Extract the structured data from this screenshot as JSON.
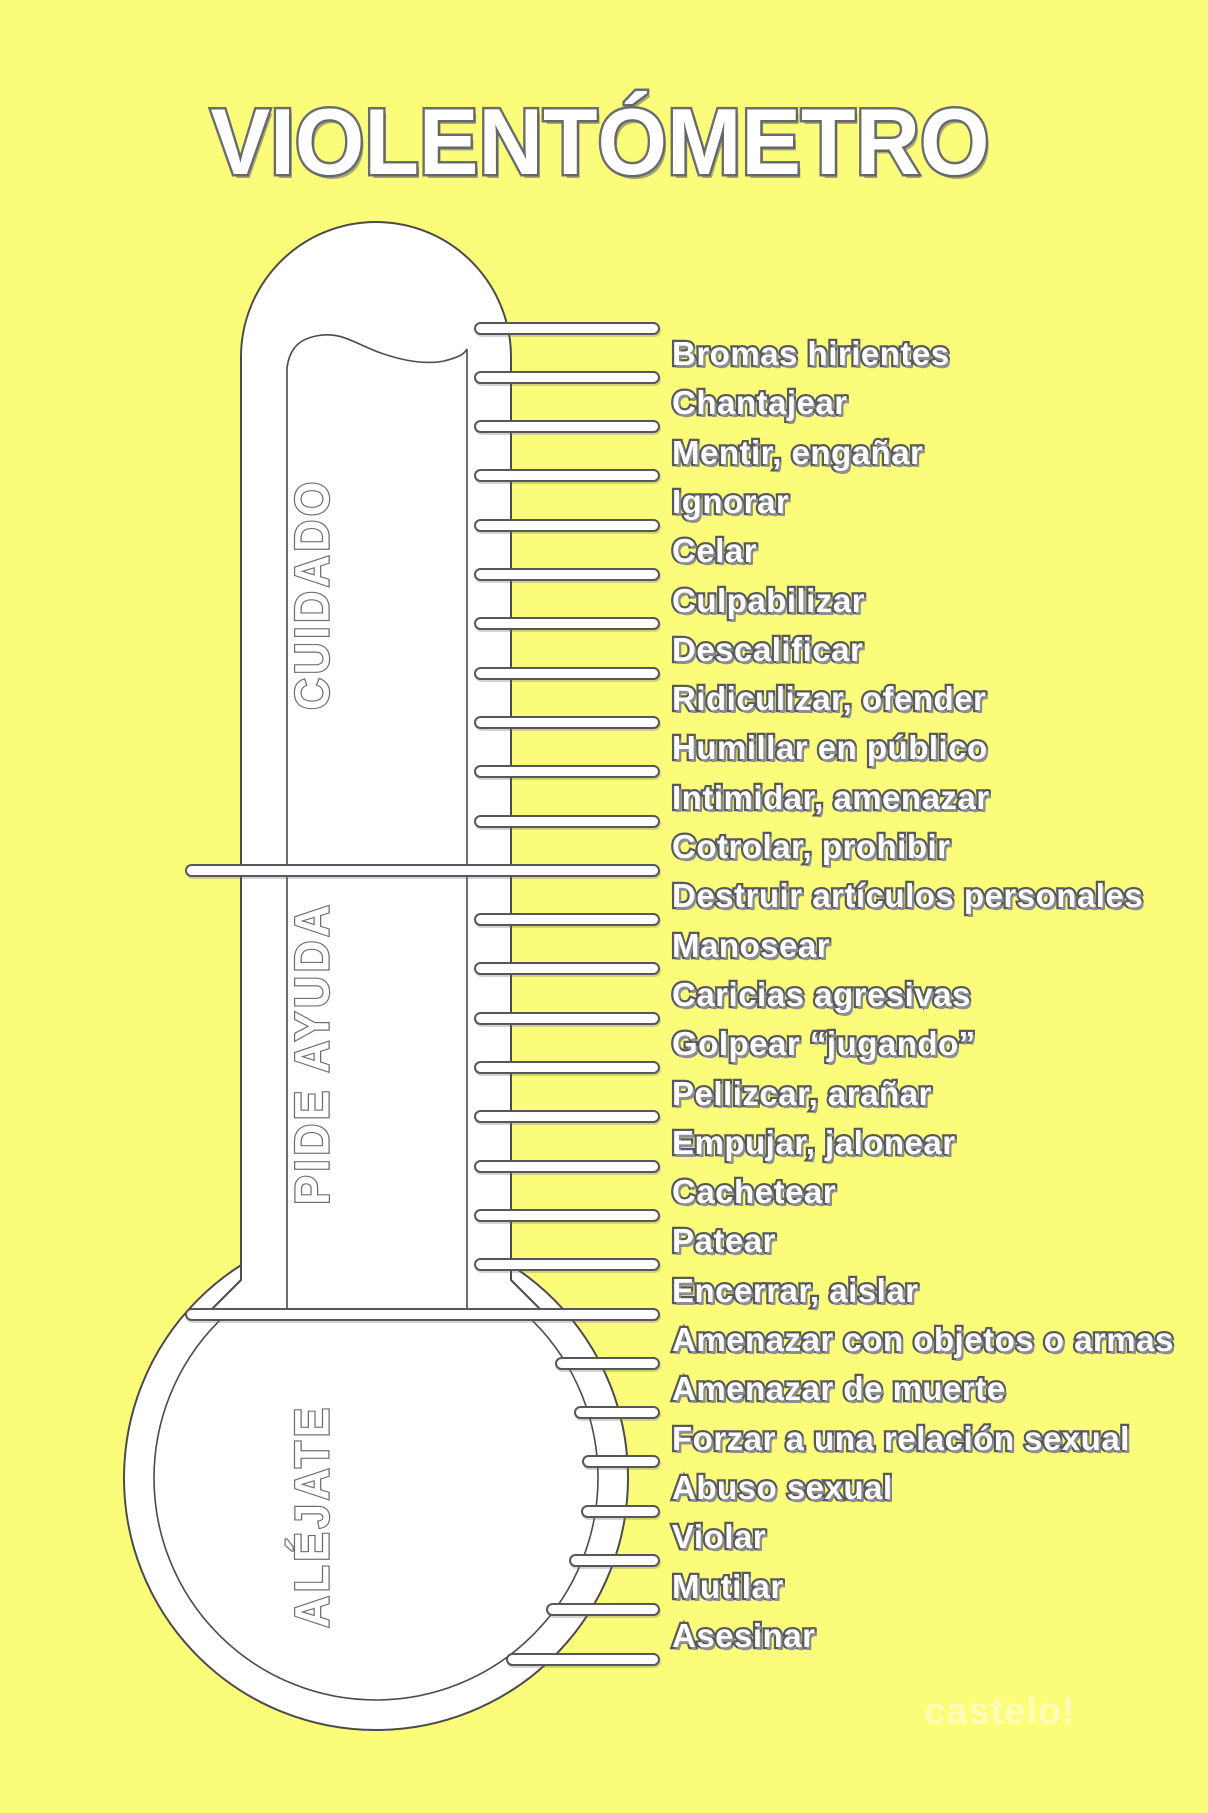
{
  "title": "VIOLENTÓMETRO",
  "palette": {
    "background": "#FCFC7B",
    "outline_dark": "#4b4b4d",
    "outline_gray": "#58595B",
    "outline_light_gray": "#6D6E71",
    "text_fill": "#FFFFFF",
    "shadow_gray": "#8d8e91"
  },
  "thermometer": {
    "sections": [
      {
        "label": "CUIDADO",
        "items": [
          "Bromas hirientes",
          "Chantajear",
          "Mentir, engañar",
          "Ignorar",
          "Celar",
          "Culpabilizar",
          "Descalificar",
          "Ridiculizar, ofender",
          "Humillar en público",
          "Intimidar, amenazar",
          "Cotrolar, prohibir"
        ]
      },
      {
        "label": "PIDE AYUDA",
        "items": [
          "Destruir artículos personales",
          "Manosear",
          "Caricias agresivas",
          "Golpear “jugando”",
          "Pellizcar, arañar",
          "Empujar, jalonear",
          "Cachetear",
          "Patear",
          "Encerrar, aislar"
        ]
      },
      {
        "label": "ALÉJATE",
        "items": [
          "Amenazar con objetos o armas",
          "Amenazar de muerte",
          "Forzar a una relación sexual",
          "Abuso sexual",
          "Violar",
          "Mutilar",
          "Asesinar"
        ]
      }
    ]
  },
  "watermark": {
    "line1": "castelo!"
  }
}
